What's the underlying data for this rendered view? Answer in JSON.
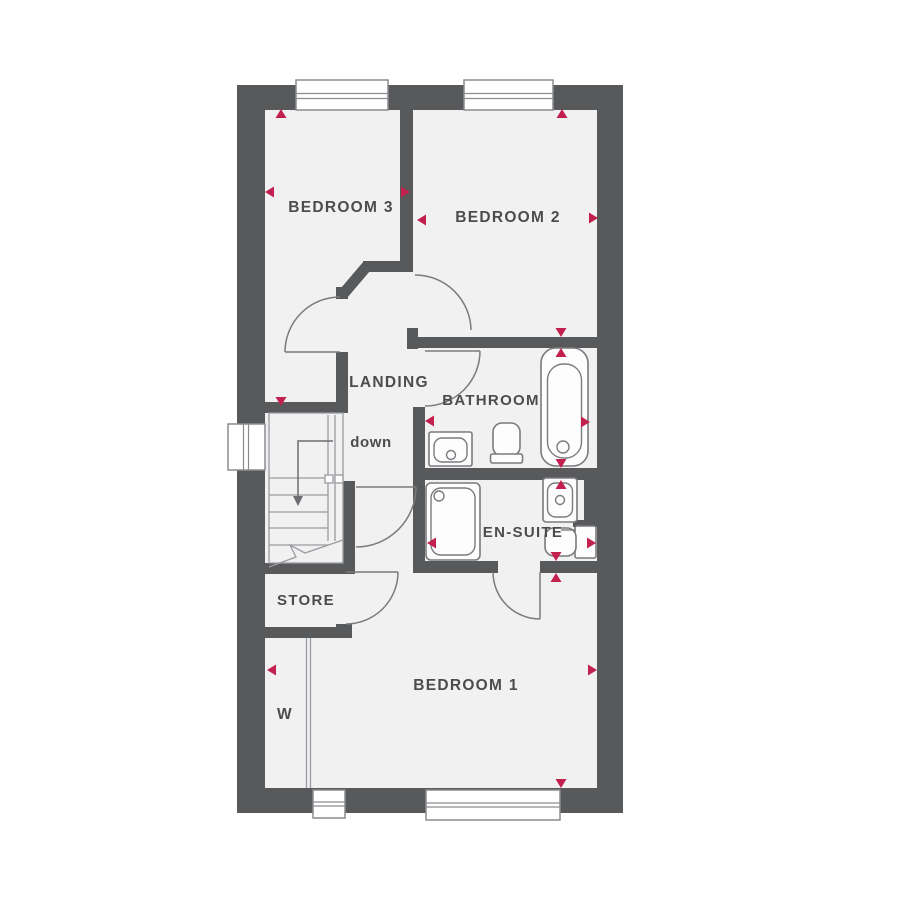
{
  "plan": {
    "title": "First floor plan",
    "labels": {
      "bedroom3": "BEDROOM 3",
      "bedroom2": "BEDROOM 2",
      "bedroom1": "BEDROOM 1",
      "landing": "LANDING",
      "bathroom": "BATHROOM",
      "ensuite": "EN-SUITE",
      "store": "STORE",
      "stairs_direction": "down",
      "wardrobe": "W"
    },
    "colors": {
      "wall": "#58595b",
      "floor": "#f1f1f2",
      "marker": "#c2204e",
      "fixture_line": "#7a7b7e",
      "text": "#4b4c4e"
    },
    "markers": [
      {
        "dir": "up",
        "x": 281,
        "y": 109
      },
      {
        "dir": "left",
        "x": 265,
        "y": 192
      },
      {
        "dir": "right",
        "x": 410,
        "y": 192
      },
      {
        "dir": "up",
        "x": 562,
        "y": 109
      },
      {
        "dir": "left",
        "x": 417,
        "y": 220
      },
      {
        "dir": "right",
        "x": 598,
        "y": 218
      },
      {
        "dir": "down",
        "x": 561,
        "y": 337
      },
      {
        "dir": "up",
        "x": 561,
        "y": 348
      },
      {
        "dir": "left",
        "x": 425,
        "y": 421
      },
      {
        "dir": "right",
        "x": 590,
        "y": 422
      },
      {
        "dir": "down",
        "x": 561,
        "y": 468
      },
      {
        "dir": "up",
        "x": 561,
        "y": 480
      },
      {
        "dir": "down",
        "x": 281,
        "y": 406
      },
      {
        "dir": "left",
        "x": 427,
        "y": 543
      },
      {
        "dir": "right",
        "x": 596,
        "y": 543
      },
      {
        "dir": "down",
        "x": 556,
        "y": 561
      },
      {
        "dir": "up",
        "x": 556,
        "y": 573
      },
      {
        "dir": "left",
        "x": 267,
        "y": 670
      },
      {
        "dir": "right",
        "x": 597,
        "y": 670
      },
      {
        "dir": "down",
        "x": 561,
        "y": 788
      }
    ]
  }
}
